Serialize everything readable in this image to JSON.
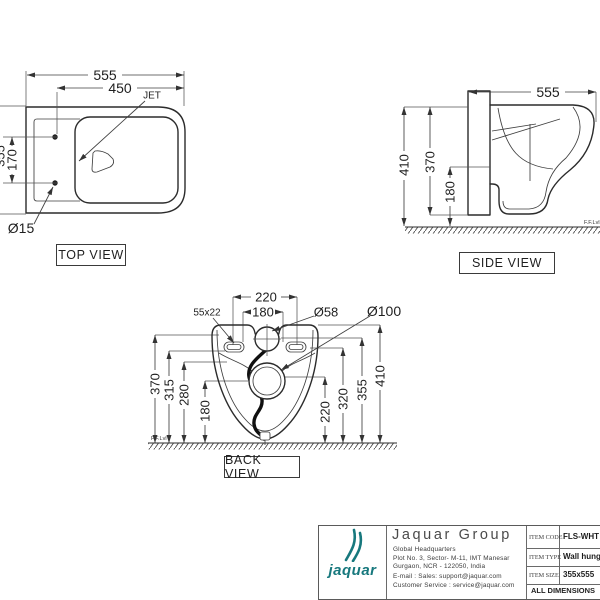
{
  "sheet": {
    "background": "#ffffff",
    "line_color": "#2b2b2b",
    "accent_color": "#17787d"
  },
  "views": {
    "top": {
      "label": "TOP VIEW",
      "dims": {
        "width": "555",
        "hole_width": "450",
        "bolt_spacing": "170",
        "depth_partial": "355",
        "hole_dia": "Ø15"
      },
      "jet_label": "JET"
    },
    "side": {
      "label": "SIDE VIEW",
      "dims": {
        "depth": "555",
        "height": "410",
        "body_height": "370",
        "outlet_height": "180"
      },
      "floor_label": "F.F.Lvl"
    },
    "back": {
      "label": "BACK VIEW",
      "dims": {
        "mount_spacing": "220",
        "inner_spacing": "180",
        "slot_size": "55x22",
        "inlet_dia": "Ø58",
        "outlet_dia": "Ø100",
        "h_370": "370",
        "h_315": "315",
        "h_280": "280",
        "h_180": "180",
        "h_220": "220",
        "h_320": "320",
        "h_355": "355",
        "h_410": "410"
      },
      "floor_label": "F.F.Lvl"
    }
  },
  "title_block": {
    "logo_word": "jaquar",
    "company": "Jaquar Group",
    "address": [
      "Global Headquarters",
      "Plot No. 3, Sector- M-11, IMT Manesar",
      "Gurgaon, NCR - 122050, India",
      "E-mail : Sales: support@jaquar.com",
      "Customer Service : service@jaquar.com"
    ],
    "rows": [
      {
        "label": "ITEM CODE",
        "value": "FLS-WHT"
      },
      {
        "label": "ITEM TYPE",
        "value": "Wall hung"
      },
      {
        "label": "ITEM SIZE",
        "value": "355x555"
      }
    ],
    "note": "ALL DIMENSIONS"
  }
}
